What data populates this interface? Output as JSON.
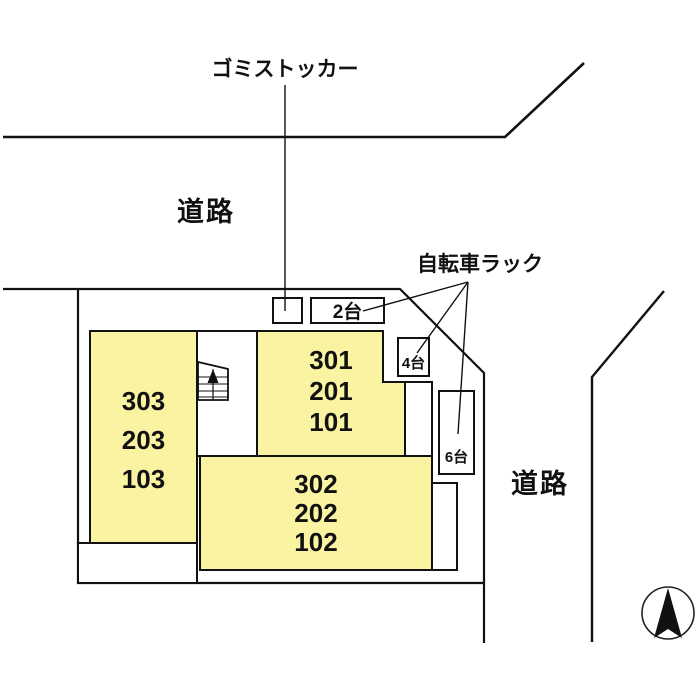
{
  "site_plan": {
    "annotations": {
      "garbage_storage": "ゴミストッカー",
      "road_top": "道路",
      "bicycle_rack": "自転車ラック",
      "road_right": "道路"
    },
    "buildings": {
      "west": {
        "units": [
          "303",
          "203",
          "103"
        ]
      },
      "northeast": {
        "units": [
          "301",
          "201",
          "101"
        ]
      },
      "south": {
        "units": [
          "302",
          "202",
          "102"
        ]
      }
    },
    "bike_racks": [
      {
        "id": "rack-2",
        "capacity": "2台"
      },
      {
        "id": "rack-4",
        "capacity": "4台"
      },
      {
        "id": "rack-6",
        "capacity": "6台"
      }
    ],
    "icons": {
      "compass": "north-arrow-icon",
      "stairs": "stairs-up-icon"
    },
    "colors": {
      "building_fill": "#FAF3A2",
      "line": "#111111",
      "background": "#FFFFFF"
    }
  }
}
